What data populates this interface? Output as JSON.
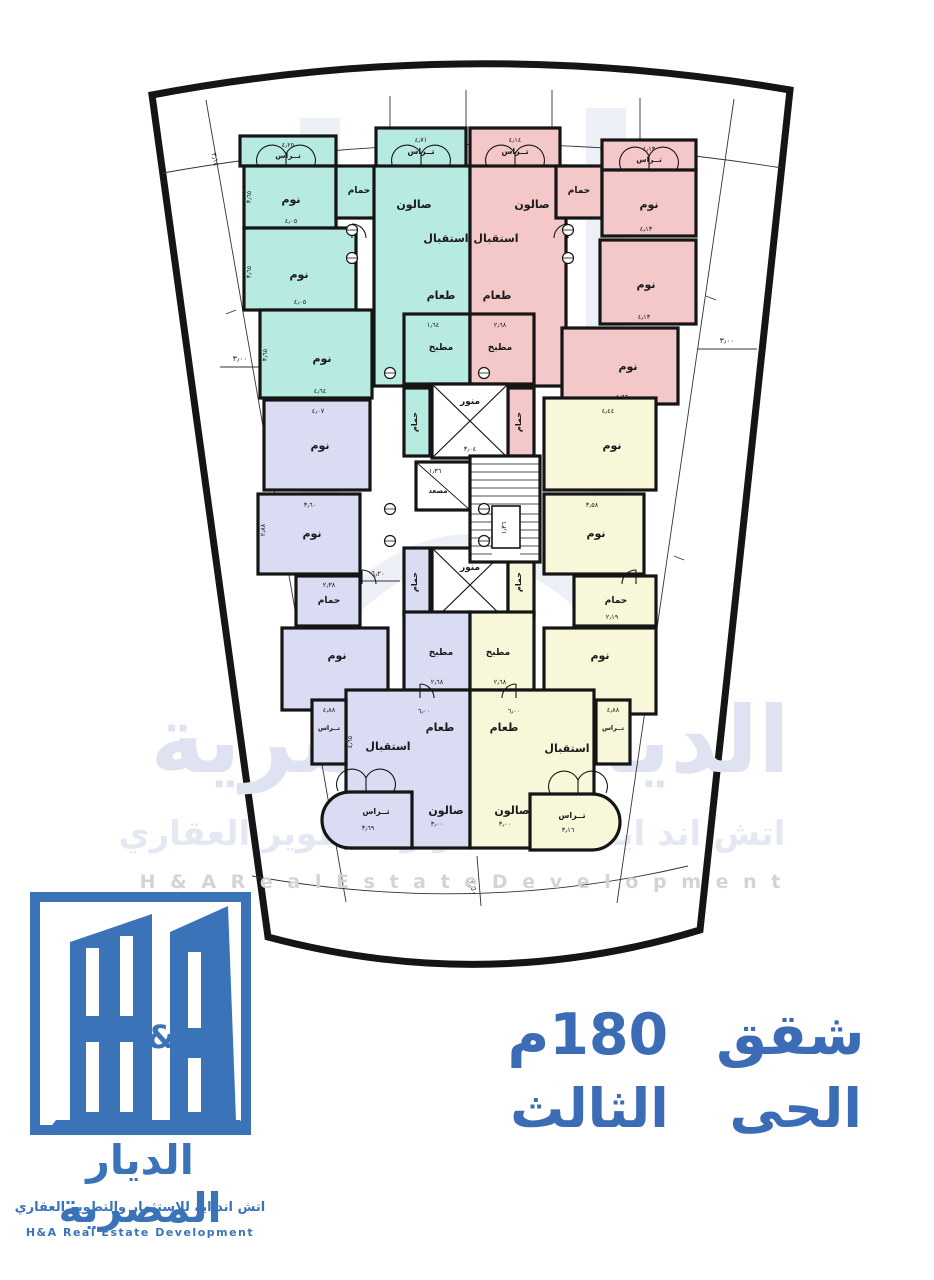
{
  "title": {
    "line1": "شقق 180م",
    "line2": "الحى الثالث"
  },
  "logo": {
    "ampersand": "&",
    "company_ar": "الديار المصرية",
    "tagline_ar": "اتش اند ايه للإستثمار والتطوير العقاري",
    "company_en": "H&A Real Estate Development"
  },
  "watermark": {
    "company_ar": "الديار المصرية",
    "tagline_ar": "اتش اند ايه للاستثمار و التطوير العقاري",
    "company_en": "H & A   R e a l   E s t a t e   D e v e l o p m e n t"
  },
  "colors": {
    "teal": "#b7eae1",
    "pink": "#f4c8c8",
    "lavender": "#d9dcf3",
    "yellow": "#f9f7da",
    "wall": "#151515",
    "brand_blue": "#3b73b8",
    "title_blue": "#3d6cb6",
    "watermark_light": "#dfe3f1",
    "watermark_gray": "#d4d4d4"
  },
  "plan": {
    "rooms": {
      "t_ter1": {
        "label": "تــراس",
        "dim": "٤٫٢٥"
      },
      "t_bed1": {
        "label": "نوم",
        "dim": "٤٫٠٥",
        "vdim": "٣٫٦٥"
      },
      "t_ham1": {
        "label": "حمام"
      },
      "t_ter2": {
        "label": "تــراس",
        "dim": "٤٫٧١"
      },
      "t_salon": {
        "label": "صالون"
      },
      "t_reception": {
        "label": "استقبال"
      },
      "t_dining": {
        "label": "طعام"
      },
      "t_bed2": {
        "label": "نوم",
        "dim": "٤٫٠٥",
        "vdim": "٣٫٦٥"
      },
      "t_bed3": {
        "label": "نوم",
        "dim": "٤٫٦٤",
        "vdim": "٣٫٦٥"
      },
      "t_kitchen": {
        "label": "مطبخ",
        "dim": "١٫٦٤"
      },
      "p_ter1": {
        "label": "تــراس",
        "dim": "٤٫١٤"
      },
      "p_salon": {
        "label": "صالون"
      },
      "p_reception": {
        "label": "استقبال"
      },
      "p_dining": {
        "label": "طعام"
      },
      "p_ham1": {
        "label": "حمام"
      },
      "p_ter2": {
        "label": "تــراس",
        "dim": "٤٫١٣"
      },
      "p_bed1": {
        "label": "نوم",
        "dim": "٤٫١٣"
      },
      "p_bed2": {
        "label": "نوم",
        "dim": "٤٫١٣"
      },
      "p_bed3": {
        "label": "نوم",
        "dim": "٤٫٦٦"
      },
      "p_kitchen": {
        "label": "مطبخ",
        "dim": "٢٫٦٨"
      },
      "c_ham_tl": {
        "label": "حمام"
      },
      "c_ham_tr": {
        "label": "حمام"
      },
      "c_lw1": {
        "label": "منور",
        "dim": "٣٫٠٤"
      },
      "c_elev": {
        "label": "مصعد",
        "dim": "١٫٣٦"
      },
      "c_lw2": {
        "label": "منور",
        "dim": "٣٫٠٤"
      },
      "c_ham_bl": {
        "label": "حمام"
      },
      "c_ham_br": {
        "label": "حمام"
      },
      "l_bed1": {
        "label": "نوم",
        "dim": "٤٫٠٧"
      },
      "l_bed2": {
        "label": "نوم",
        "dim": "٣٫٦٠",
        "vdim": "٢٫٨٨"
      },
      "l_ham": {
        "label": "حمام",
        "dim": "٢٫٣٨"
      },
      "l_bed3": {
        "label": "نوم",
        "dim": "٣٫٦٥"
      },
      "l_kitchen": {
        "label": "مطبخ",
        "dim": "٢٫٦٨"
      },
      "l_dining": {
        "label": "طعام",
        "dim": "٦٫٠٠"
      },
      "l_reception": {
        "label": "استقبال"
      },
      "l_salon": {
        "label": "صالون",
        "dim": "٣٫٠٠"
      },
      "l_ter_side": {
        "label": "تــراس",
        "dim": "٤٫٨٨"
      },
      "l_ter_round": {
        "label": "تــراس",
        "dim": "٣٫٦٩"
      },
      "y_bed1": {
        "label": "نوم",
        "dim": "٤٫٤٤"
      },
      "y_bed2": {
        "label": "نوم",
        "dim": "٣٫٥٨"
      },
      "y_ham": {
        "label": "حمام",
        "dim": "٢٫١٩"
      },
      "y_bed3": {
        "label": "نوم",
        "dim": "٤٫٤٨"
      },
      "y_kitchen": {
        "label": "مطبخ",
        "dim": "٢٫٦٨"
      },
      "y_dining": {
        "label": "طعام",
        "dim": "٦٫٠٠"
      },
      "y_reception": {
        "label": "استقبال"
      },
      "y_salon": {
        "label": "صالون",
        "dim": "٣٫٠٠"
      },
      "y_ter_side": {
        "label": "تــراس",
        "dim": "٤٫٨٨"
      },
      "y_ter_round": {
        "label": "تــراس",
        "dim": "٣٫١٦"
      }
    },
    "annotations": {
      "setback_left": "٣٫٠٠",
      "setback_right": "٣٫٠٠",
      "setback_bottom": "٣٫٥٠",
      "survey_top_left": "٣٫١٤",
      "hall_width": "٦٫٢٠",
      "stair_width": "١٫٣٦",
      "reception_height": "٤٫٦٥"
    }
  }
}
